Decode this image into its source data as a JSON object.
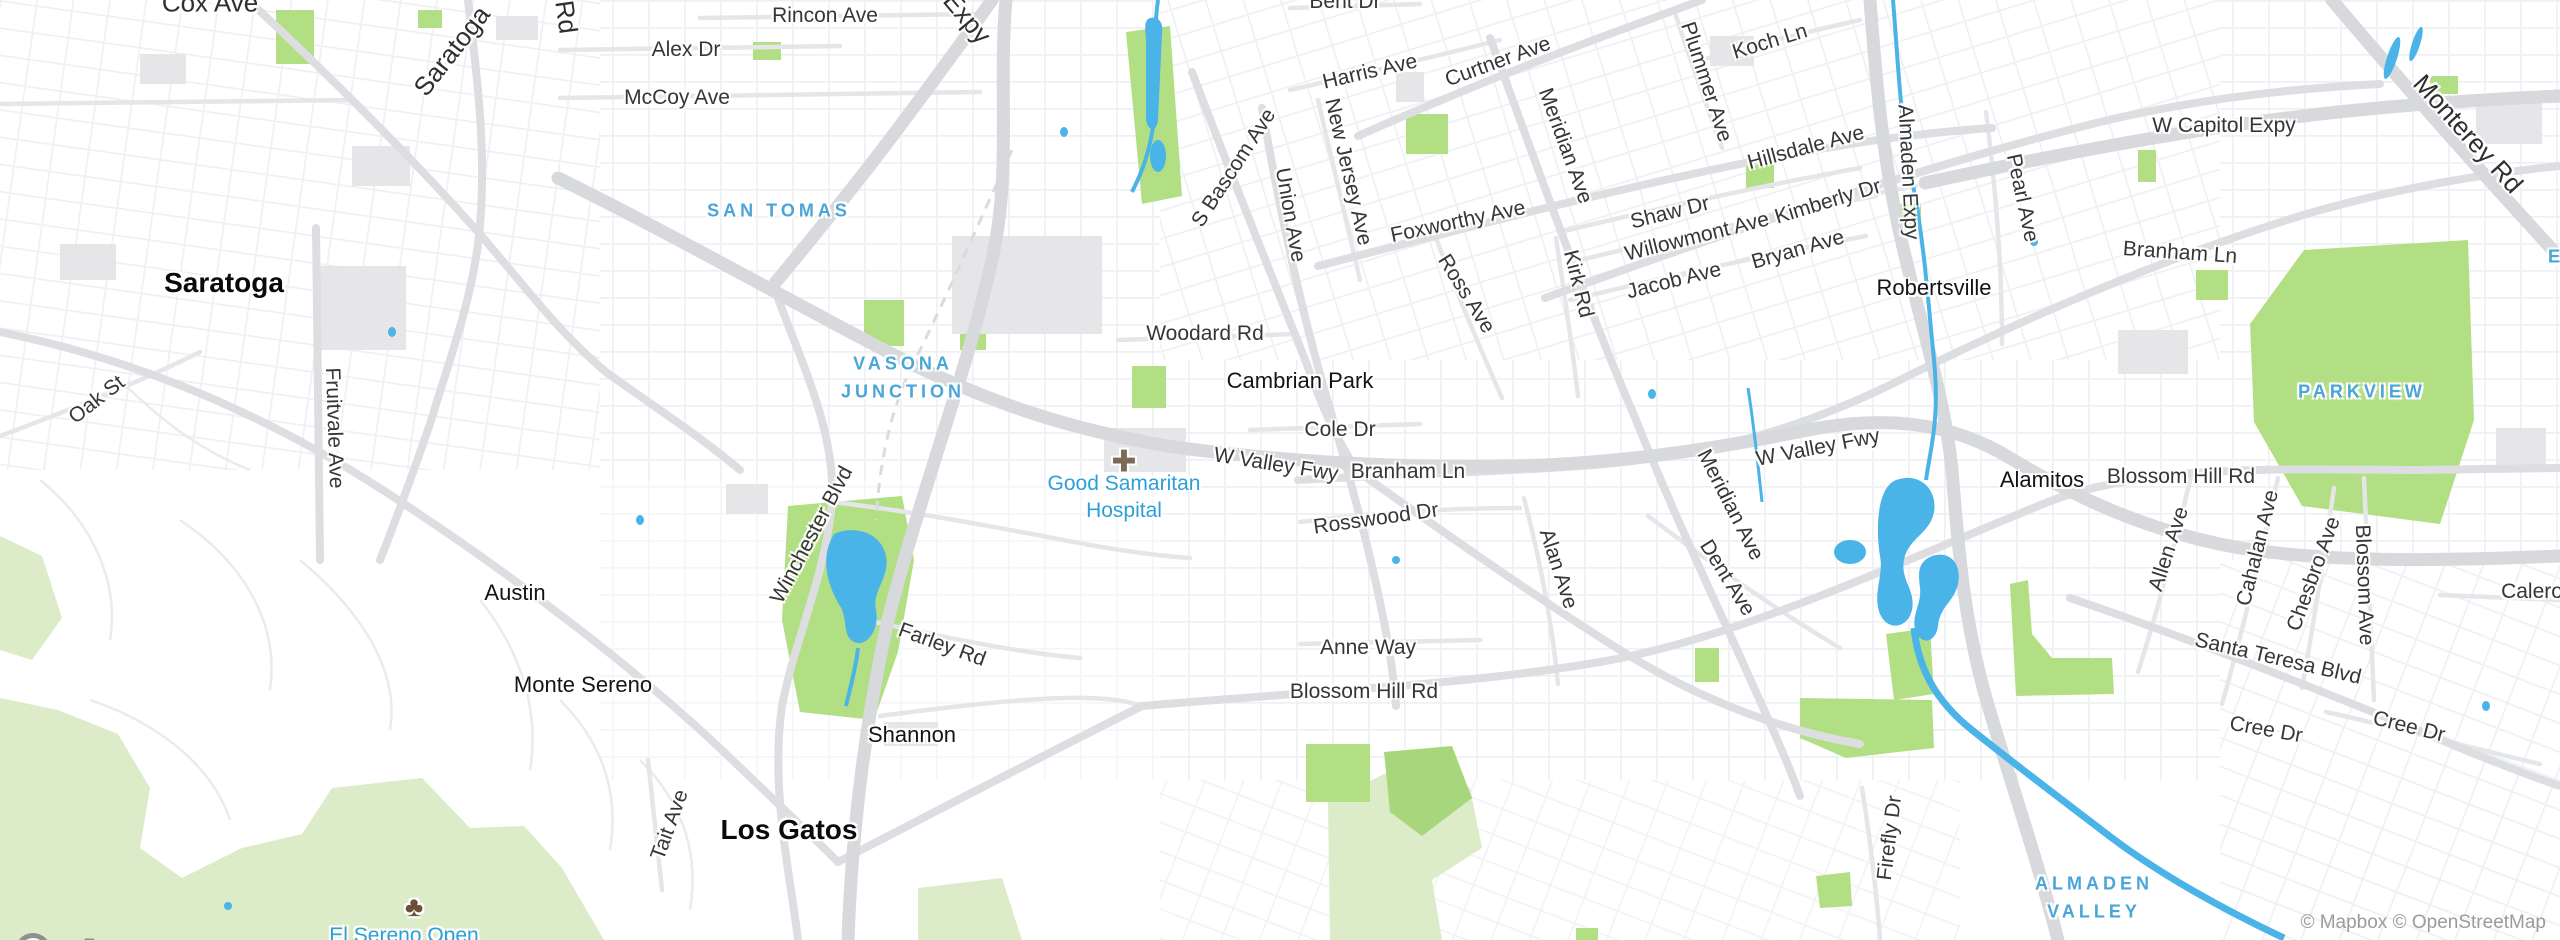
{
  "map": {
    "provider_logo": "mapbox",
    "attribution": "© Mapbox © OpenStreetMap",
    "colors": {
      "background": "#ffffff",
      "water": "#4ab3e8",
      "park": "#b2df84",
      "open_space": "#dcecc8",
      "freeway": "#d8d9dc",
      "arterial": "#dddee1",
      "collector": "#e5e6e9",
      "building": "#e6e6e8",
      "area_label": "#4aa5d8",
      "poi_label": "#2d9fd8",
      "street_label": "#363636",
      "city_label": "#0a0a0a",
      "attribution_text": "#9b9b9b",
      "logo_gray": "#8f9090"
    },
    "icons": [
      {
        "name": "hospital-cross-icon",
        "glyph": "✚",
        "x": 1124,
        "y": 462,
        "color": "#7d6a55",
        "size": 30
      },
      {
        "name": "tree-icon",
        "glyph": "♣",
        "x": 414,
        "y": 907,
        "color": "#6d4f35",
        "size": 28
      }
    ],
    "labels": [
      {
        "name": "street-label-cox-ave",
        "text": "Cox Ave",
        "x": 210,
        "y": 3,
        "rot": 0,
        "cls": "street-lg"
      },
      {
        "name": "street-label-saratoga-ave",
        "text": "Saratoga",
        "x": 452,
        "y": 51,
        "rot": -52,
        "cls": "street-lg"
      },
      {
        "name": "street-label-quito-rd",
        "text": "Rd",
        "x": 566,
        "y": 17,
        "rot": 82,
        "cls": "street-lg"
      },
      {
        "name": "street-label-rincon-ave",
        "text": "Rincon Ave",
        "x": 825,
        "y": 16,
        "rot": 0,
        "cls": "street"
      },
      {
        "name": "street-label-alex-dr",
        "text": "Alex Dr",
        "x": 686,
        "y": 50,
        "rot": 0,
        "cls": "street"
      },
      {
        "name": "street-label-mccoy-ave",
        "text": "McCoy Ave",
        "x": 677,
        "y": 98,
        "rot": 0,
        "cls": "street"
      },
      {
        "name": "street-label-san-tomas-expy",
        "text": "Expy",
        "x": 967,
        "y": 18,
        "rot": 50,
        "cls": "street-lg"
      },
      {
        "name": "street-label-bent-dr",
        "text": "Bent Dr",
        "x": 1345,
        "y": 2,
        "rot": 0,
        "cls": "street"
      },
      {
        "name": "street-label-harris-ave",
        "text": "Harris Ave",
        "x": 1370,
        "y": 72,
        "rot": -13,
        "cls": "street"
      },
      {
        "name": "street-label-curtner-ave",
        "text": "Curtner Ave",
        "x": 1498,
        "y": 62,
        "rot": -20,
        "cls": "street"
      },
      {
        "name": "street-label-meridian-ave-n",
        "text": "Meridian Ave",
        "x": 1565,
        "y": 146,
        "rot": 70,
        "cls": "street"
      },
      {
        "name": "street-label-plummer-ave",
        "text": "Plummer Ave",
        "x": 1706,
        "y": 82,
        "rot": 72,
        "cls": "street"
      },
      {
        "name": "street-label-koch-ln",
        "text": "Koch Ln",
        "x": 1770,
        "y": 42,
        "rot": -17,
        "cls": "street"
      },
      {
        "name": "street-label-hillsdale-ave",
        "text": "Hillsdale Ave",
        "x": 1806,
        "y": 148,
        "rot": -15,
        "cls": "street"
      },
      {
        "name": "street-label-almaden-expy-n",
        "text": "Almaden Expy",
        "x": 1908,
        "y": 172,
        "rot": 87,
        "cls": "street"
      },
      {
        "name": "street-label-pearl-ave",
        "text": "Pearl Ave",
        "x": 2022,
        "y": 198,
        "rot": 78,
        "cls": "street"
      },
      {
        "name": "street-label-w-capitol-expy",
        "text": "W Capitol Expy",
        "x": 2224,
        "y": 126,
        "rot": 0,
        "cls": "street"
      },
      {
        "name": "street-label-monterey-rd",
        "text": "Monterey Rd",
        "x": 2468,
        "y": 134,
        "rot": 48,
        "cls": "street-lg"
      },
      {
        "name": "street-label-branham-ln-e",
        "text": "Branham Ln",
        "x": 2180,
        "y": 253,
        "rot": 4,
        "cls": "street"
      },
      {
        "name": "street-label-s-bascom-ave",
        "text": "S Bascom Ave",
        "x": 1234,
        "y": 168,
        "rot": -57,
        "cls": "street"
      },
      {
        "name": "street-label-union-ave",
        "text": "Union Ave",
        "x": 1290,
        "y": 215,
        "rot": 80,
        "cls": "street"
      },
      {
        "name": "street-label-new-jersey-ave",
        "text": "New Jersey Ave",
        "x": 1348,
        "y": 172,
        "rot": 77,
        "cls": "street"
      },
      {
        "name": "street-label-foxworthy-ave",
        "text": "Foxworthy Ave",
        "x": 1458,
        "y": 222,
        "rot": -12,
        "cls": "street"
      },
      {
        "name": "street-label-ross-ave",
        "text": "Ross Ave",
        "x": 1466,
        "y": 294,
        "rot": 58,
        "cls": "street"
      },
      {
        "name": "street-label-kirk-rd",
        "text": "Kirk Rd",
        "x": 1578,
        "y": 284,
        "rot": 76,
        "cls": "street"
      },
      {
        "name": "street-label-shaw-dr",
        "text": "Shaw Dr",
        "x": 1670,
        "y": 213,
        "rot": -14,
        "cls": "street"
      },
      {
        "name": "street-label-willowmont-ave",
        "text": "Willowmont Ave",
        "x": 1697,
        "y": 237,
        "rot": -14,
        "cls": "street"
      },
      {
        "name": "street-label-jacob-ave",
        "text": "Jacob Ave",
        "x": 1674,
        "y": 281,
        "rot": -14,
        "cls": "street"
      },
      {
        "name": "street-label-bryan-ave",
        "text": "Bryan Ave",
        "x": 1798,
        "y": 250,
        "rot": -16,
        "cls": "street"
      },
      {
        "name": "street-label-kimberly-dr",
        "text": "Kimberly Dr",
        "x": 1828,
        "y": 202,
        "rot": -17,
        "cls": "street"
      },
      {
        "name": "street-label-woodard-rd",
        "text": "Woodard Rd",
        "x": 1205,
        "y": 334,
        "rot": 0,
        "cls": "street"
      },
      {
        "name": "street-label-cole-dr",
        "text": "Cole Dr",
        "x": 1340,
        "y": 430,
        "rot": 0,
        "cls": "street"
      },
      {
        "name": "street-label-w-valley-fwy-w",
        "text": "W Valley Fwy",
        "x": 1276,
        "y": 465,
        "rot": 9,
        "cls": "street"
      },
      {
        "name": "street-label-branham-ln-w",
        "text": "Branham Ln",
        "x": 1408,
        "y": 472,
        "rot": 0,
        "cls": "street"
      },
      {
        "name": "street-label-rosswood-dr",
        "text": "Rosswood Dr",
        "x": 1376,
        "y": 519,
        "rot": -8,
        "cls": "street"
      },
      {
        "name": "street-label-anne-way",
        "text": "Anne Way",
        "x": 1368,
        "y": 648,
        "rot": 0,
        "cls": "street"
      },
      {
        "name": "street-label-blossom-hill-rd-w",
        "text": "Blossom Hill Rd",
        "x": 1364,
        "y": 692,
        "rot": 0,
        "cls": "street"
      },
      {
        "name": "street-label-alan-ave",
        "text": "Alan Ave",
        "x": 1558,
        "y": 569,
        "rot": 72,
        "cls": "street"
      },
      {
        "name": "street-label-meridian-ave-s",
        "text": "Meridian Ave",
        "x": 1730,
        "y": 505,
        "rot": 63,
        "cls": "street"
      },
      {
        "name": "street-label-dent-ave",
        "text": "Dent Ave",
        "x": 1727,
        "y": 578,
        "rot": 58,
        "cls": "street"
      },
      {
        "name": "street-label-w-valley-fwy-e",
        "text": "W Valley Fwy",
        "x": 1818,
        "y": 448,
        "rot": -11,
        "cls": "street"
      },
      {
        "name": "street-label-blossom-hill-rd-e",
        "text": "Blossom Hill Rd",
        "x": 2181,
        "y": 477,
        "rot": 0,
        "cls": "street"
      },
      {
        "name": "street-label-allen-ave",
        "text": "Allen Ave",
        "x": 2169,
        "y": 549,
        "rot": -72,
        "cls": "street"
      },
      {
        "name": "street-label-cahalan-ave",
        "text": "Cahalan Ave",
        "x": 2258,
        "y": 548,
        "rot": -76,
        "cls": "street"
      },
      {
        "name": "street-label-chesbro-ave",
        "text": "Chesbro Ave",
        "x": 2314,
        "y": 574,
        "rot": -70,
        "cls": "street"
      },
      {
        "name": "street-label-blossom-ave",
        "text": "Blossom Ave",
        "x": 2364,
        "y": 585,
        "rot": 88,
        "cls": "street"
      },
      {
        "name": "street-label-santa-teresa-blvd",
        "text": "Santa Teresa Blvd",
        "x": 2278,
        "y": 659,
        "rot": 13,
        "cls": "street"
      },
      {
        "name": "street-label-cree-dr-w",
        "text": "Cree Dr",
        "x": 2266,
        "y": 730,
        "rot": 10,
        "cls": "street"
      },
      {
        "name": "street-label-cree-dr-e",
        "text": "Cree Dr",
        "x": 2409,
        "y": 727,
        "rot": 14,
        "cls": "street"
      },
      {
        "name": "street-label-calero",
        "text": "Calero",
        "x": 2532,
        "y": 592,
        "rot": 0,
        "cls": "street"
      },
      {
        "name": "street-label-oak-st",
        "text": "Oak St",
        "x": 97,
        "y": 400,
        "rot": -38,
        "cls": "street"
      },
      {
        "name": "street-label-fruitvale-ave",
        "text": "Fruitvale Ave",
        "x": 334,
        "y": 428,
        "rot": 88,
        "cls": "street"
      },
      {
        "name": "street-label-winchester-blvd",
        "text": "Winchester Blvd",
        "x": 812,
        "y": 535,
        "rot": -62,
        "cls": "street"
      },
      {
        "name": "street-label-farley-rd",
        "text": "Farley Rd",
        "x": 942,
        "y": 645,
        "rot": 20,
        "cls": "street"
      },
      {
        "name": "street-label-tait-ave",
        "text": "Tait Ave",
        "x": 670,
        "y": 825,
        "rot": -70,
        "cls": "street"
      },
      {
        "name": "street-label-firefly-dr",
        "text": "Firefly Dr",
        "x": 1890,
        "y": 838,
        "rot": -83,
        "cls": "street"
      },
      {
        "name": "city-label-saratoga",
        "text": "Saratoga",
        "x": 224,
        "y": 283,
        "rot": 0,
        "cls": "city"
      },
      {
        "name": "city-label-los-gatos",
        "text": "Los Gatos",
        "x": 789,
        "y": 830,
        "rot": 0,
        "cls": "city"
      },
      {
        "name": "town-label-austin",
        "text": "Austin",
        "x": 515,
        "y": 593,
        "rot": 0,
        "cls": "town"
      },
      {
        "name": "town-label-monte-sereno",
        "text": "Monte Sereno",
        "x": 583,
        "y": 685,
        "rot": 0,
        "cls": "town"
      },
      {
        "name": "town-label-shannon",
        "text": "Shannon",
        "x": 912,
        "y": 735,
        "rot": 0,
        "cls": "town"
      },
      {
        "name": "town-label-cambrian-park",
        "text": "Cambrian Park",
        "x": 1300,
        "y": 381,
        "rot": 0,
        "cls": "town"
      },
      {
        "name": "town-label-robertsville",
        "text": "Robertsville",
        "x": 1934,
        "y": 288,
        "rot": 0,
        "cls": "town"
      },
      {
        "name": "town-label-alamitos",
        "text": "Alamitos",
        "x": 2042,
        "y": 480,
        "rot": 0,
        "cls": "town"
      },
      {
        "name": "area-label-san-tomas",
        "text": "SAN TOMAS",
        "x": 779,
        "y": 211,
        "rot": 0,
        "cls": "area"
      },
      {
        "name": "area-label-vasona-junction-1",
        "text": "VASONA",
        "x": 903,
        "y": 364,
        "rot": 0,
        "cls": "area"
      },
      {
        "name": "area-label-vasona-junction-2",
        "text": "JUNCTION",
        "x": 903,
        "y": 392,
        "rot": 0,
        "cls": "area"
      },
      {
        "name": "area-label-parkview",
        "text": "PARKVIEW",
        "x": 2362,
        "y": 392,
        "rot": 0,
        "cls": "area"
      },
      {
        "name": "area-label-almaden-valley-1",
        "text": "ALMADEN",
        "x": 2094,
        "y": 884,
        "rot": 0,
        "cls": "area"
      },
      {
        "name": "area-label-almaden-valley-2",
        "text": "VALLEY",
        "x": 2094,
        "y": 912,
        "rot": 0,
        "cls": "area"
      },
      {
        "name": "area-label-edge-partial",
        "text": "E",
        "x": 2556,
        "y": 257,
        "rot": 0,
        "cls": "area"
      },
      {
        "name": "poi-label-good-samaritan-1",
        "text": "Good Samaritan",
        "x": 1124,
        "y": 484,
        "rot": 0,
        "cls": "poi"
      },
      {
        "name": "poi-label-good-samaritan-2",
        "text": "Hospital",
        "x": 1124,
        "y": 511,
        "rot": 0,
        "cls": "poi"
      },
      {
        "name": "poi-label-el-sereno-open",
        "text": "El Sereno Open",
        "x": 404,
        "y": 936,
        "rot": 0,
        "cls": "poi"
      }
    ]
  }
}
